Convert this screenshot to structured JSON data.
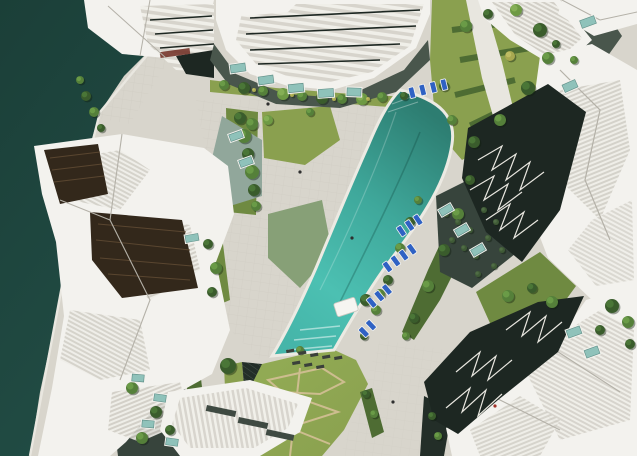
{
  "meta": {
    "description": "Top-down aerial architectural rendering: white faceted apartment buildings around a paved plaza, marina water at the left edge, gardens, and a long curved turquoise infinity pool with blue sun loungers.",
    "width": 637,
    "height": 456
  },
  "palette": {
    "paving": "#d8d5cc",
    "paving_light": "#e8e6df",
    "water": "#224e46",
    "water_deep": "#1b3f38",
    "pool_top": "#2d7d71",
    "pool_mid": "#3fa89b",
    "pool_bright": "#4cc0b2",
    "pool_low": "#45b5a9",
    "pool_edge": "#eceae3",
    "lawn": "#8aa04f",
    "lawn_bright": "#93ad55",
    "lawn_dark": "#6f8a41",
    "hedge": "#4e6c33",
    "moss": "#87a077",
    "court_green": "#91a79b",
    "dark_court": "#49564c",
    "darker_court": "#37443c",
    "sunken": "#232e28",
    "facade_dark": "#1d2722",
    "glass_brown": "#33281b",
    "glass_brown_line": "#5a4630",
    "building_white": "#f3f2ee",
    "building_shade": "#e2e0d9",
    "building_line": "#b4b1a8",
    "cabana": "#f6f5f1",
    "path_tan": "#cdbd8f",
    "lounger_blue": "#2f62c4",
    "lounger_dark": "#3a403a",
    "skylight_teal": "#8fc2ba",
    "skylight_frame": "#f2f1ec",
    "accent_red": "#a03228",
    "accent_maroon": "#6e2a20",
    "tree_dark": "#3a5c2c",
    "tree_dark_hi": "#4e7a39",
    "tree_mid": "#55803a",
    "tree_mid_hi": "#6fa04a",
    "tree_light": "#6e9a44",
    "tree_light_hi": "#8ab358",
    "tree_yellow": "#a8a850",
    "tree_yellow_hi": "#c2bf66",
    "shrub": "#3f5a36",
    "shrub_hi": "#527048"
  },
  "scene": {
    "trees": [
      [
        224,
        85,
        5,
        "mid"
      ],
      [
        244,
        88,
        6,
        "dark"
      ],
      [
        263,
        91,
        5,
        "mid"
      ],
      [
        283,
        94,
        6,
        "light"
      ],
      [
        302,
        96,
        5,
        "mid"
      ],
      [
        322,
        98,
        6,
        "dark"
      ],
      [
        342,
        99,
        5,
        "mid"
      ],
      [
        362,
        99,
        6,
        "light"
      ],
      [
        382,
        97,
        5,
        "mid"
      ],
      [
        404,
        96,
        4,
        "dark"
      ],
      [
        254,
        90,
        2,
        "yellow"
      ],
      [
        292,
        95,
        2,
        "yellow"
      ],
      [
        334,
        99,
        2,
        "yellow"
      ],
      [
        368,
        99,
        2,
        "yellow"
      ],
      [
        240,
        118,
        6,
        "dark"
      ],
      [
        244,
        136,
        7,
        "mid"
      ],
      [
        248,
        154,
        6,
        "dark"
      ],
      [
        252,
        172,
        7,
        "mid"
      ],
      [
        254,
        190,
        6,
        "dark"
      ],
      [
        256,
        206,
        5,
        "mid"
      ],
      [
        268,
        120,
        5,
        "light"
      ],
      [
        310,
        112,
        4,
        "mid"
      ],
      [
        208,
        244,
        5,
        "dark"
      ],
      [
        216,
        268,
        6,
        "mid"
      ],
      [
        212,
        292,
        5,
        "dark"
      ],
      [
        252,
        124,
        6,
        "mid"
      ],
      [
        86,
        96,
        5,
        "dark"
      ],
      [
        94,
        112,
        5,
        "mid"
      ],
      [
        101,
        128,
        4,
        "dark"
      ],
      [
        80,
        80,
        4,
        "mid"
      ],
      [
        466,
        26,
        6,
        "mid"
      ],
      [
        488,
        14,
        5,
        "dark"
      ],
      [
        516,
        10,
        6,
        "light"
      ],
      [
        540,
        30,
        7,
        "dark"
      ],
      [
        548,
        58,
        6,
        "mid"
      ],
      [
        528,
        88,
        7,
        "dark"
      ],
      [
        500,
        120,
        6,
        "mid"
      ],
      [
        474,
        142,
        6,
        "dark"
      ],
      [
        452,
        120,
        5,
        "mid"
      ],
      [
        444,
        86,
        5,
        "dark"
      ],
      [
        510,
        56,
        5,
        "yellow"
      ],
      [
        470,
        180,
        5,
        "dark"
      ],
      [
        458,
        214,
        6,
        "mid"
      ],
      [
        444,
        250,
        6,
        "dark"
      ],
      [
        428,
        286,
        6,
        "mid"
      ],
      [
        414,
        318,
        5,
        "dark"
      ],
      [
        406,
        336,
        4,
        "mid"
      ],
      [
        410,
        222,
        5,
        "dark"
      ],
      [
        400,
        248,
        5,
        "mid"
      ],
      [
        388,
        280,
        5,
        "dark"
      ],
      [
        376,
        310,
        5,
        "mid"
      ],
      [
        364,
        336,
        4,
        "dark"
      ],
      [
        418,
        200,
        4,
        "mid"
      ],
      [
        446,
        214,
        3,
        "shrub"
      ],
      [
        458,
        222,
        3,
        "shrub"
      ],
      [
        470,
        230,
        3,
        "shrub"
      ],
      [
        452,
        240,
        3,
        "shrub"
      ],
      [
        464,
        248,
        3,
        "shrub"
      ],
      [
        476,
        256,
        3,
        "shrub"
      ],
      [
        488,
        238,
        3,
        "shrub"
      ],
      [
        496,
        222,
        3,
        "shrub"
      ],
      [
        484,
        210,
        3,
        "shrub"
      ],
      [
        502,
        250,
        3,
        "shrub"
      ],
      [
        494,
        266,
        3,
        "shrub"
      ],
      [
        478,
        274,
        3,
        "shrub"
      ],
      [
        508,
        296,
        6,
        "mid"
      ],
      [
        532,
        288,
        5,
        "dark"
      ],
      [
        552,
        302,
        6,
        "mid"
      ],
      [
        612,
        306,
        7,
        "dark"
      ],
      [
        628,
        322,
        6,
        "mid"
      ],
      [
        600,
        330,
        5,
        "dark"
      ],
      [
        630,
        344,
        5,
        "dark"
      ],
      [
        228,
        366,
        8,
        "dark"
      ],
      [
        366,
        300,
        6,
        "dark"
      ],
      [
        380,
        294,
        5,
        "mid"
      ],
      [
        300,
        350,
        4,
        "mid"
      ],
      [
        132,
        388,
        6,
        "mid"
      ],
      [
        156,
        412,
        6,
        "dark"
      ],
      [
        142,
        438,
        6,
        "mid"
      ],
      [
        170,
        430,
        5,
        "dark"
      ],
      [
        556,
        44,
        4,
        "dark"
      ],
      [
        574,
        60,
        4,
        "mid"
      ],
      [
        432,
        416,
        4,
        "dark"
      ],
      [
        438,
        436,
        4,
        "mid"
      ],
      [
        366,
        394,
        4,
        "dark"
      ],
      [
        374,
        414,
        4,
        "mid"
      ]
    ],
    "skylights": [
      [
        238,
        68,
        15,
        8,
        -8
      ],
      [
        266,
        80,
        15,
        8,
        -8
      ],
      [
        296,
        88,
        15,
        8,
        -6
      ],
      [
        326,
        93,
        15,
        8,
        -4
      ],
      [
        354,
        92,
        14,
        8,
        2
      ],
      [
        236,
        136,
        13,
        7,
        -20
      ],
      [
        246,
        162,
        13,
        7,
        -20
      ],
      [
        588,
        22,
        15,
        8,
        -20
      ],
      [
        570,
        86,
        14,
        8,
        -24
      ],
      [
        446,
        210,
        13,
        7,
        -30
      ],
      [
        462,
        230,
        13,
        7,
        -30
      ],
      [
        478,
        250,
        13,
        7,
        -30
      ],
      [
        138,
        378,
        12,
        7,
        5
      ],
      [
        160,
        398,
        12,
        7,
        8
      ],
      [
        148,
        424,
        12,
        7,
        5
      ],
      [
        172,
        442,
        12,
        7,
        8
      ],
      [
        192,
        238,
        13,
        7,
        -10
      ],
      [
        574,
        332,
        14,
        8,
        -20
      ],
      [
        592,
        352,
        14,
        8,
        -20
      ]
    ],
    "lounger_groups": [
      {
        "x": 408,
        "y": 88,
        "angle": -14,
        "count": 4,
        "gap": 11
      },
      {
        "x": 396,
        "y": 228,
        "angle": -34,
        "count": 3,
        "gap": 10
      },
      {
        "x": 382,
        "y": 264,
        "angle": -36,
        "count": 4,
        "gap": 10
      },
      {
        "x": 366,
        "y": 300,
        "angle": -40,
        "count": 3,
        "gap": 10
      },
      {
        "x": 358,
        "y": 330,
        "angle": -44,
        "count": 2,
        "gap": 10
      }
    ],
    "bottom_loungers": [
      [
        286,
        350,
        -10
      ],
      [
        298,
        352,
        -10
      ],
      [
        310,
        354,
        -10
      ],
      [
        322,
        356,
        -10
      ],
      [
        334,
        357,
        -10
      ],
      [
        292,
        362,
        -10
      ],
      [
        304,
        364,
        -10
      ],
      [
        316,
        366,
        -10
      ]
    ],
    "lawn_paths": [
      "M268,380 L322,368 L344,382 L320,394 L282,392 Z",
      "M258,412 L310,402 L338,412 L300,424 L266,422 Z",
      "M250,440 L300,432 L330,444",
      "M300,368 L290,456"
    ],
    "people_dots": [
      [
        393,
        402,
        "#2f2f2f"
      ],
      [
        495,
        406,
        "#a03228"
      ],
      [
        352,
        238,
        "#2f2f2f"
      ],
      [
        300,
        172,
        "#2f2f2f"
      ],
      [
        268,
        104,
        "#2f2f2f"
      ]
    ]
  }
}
